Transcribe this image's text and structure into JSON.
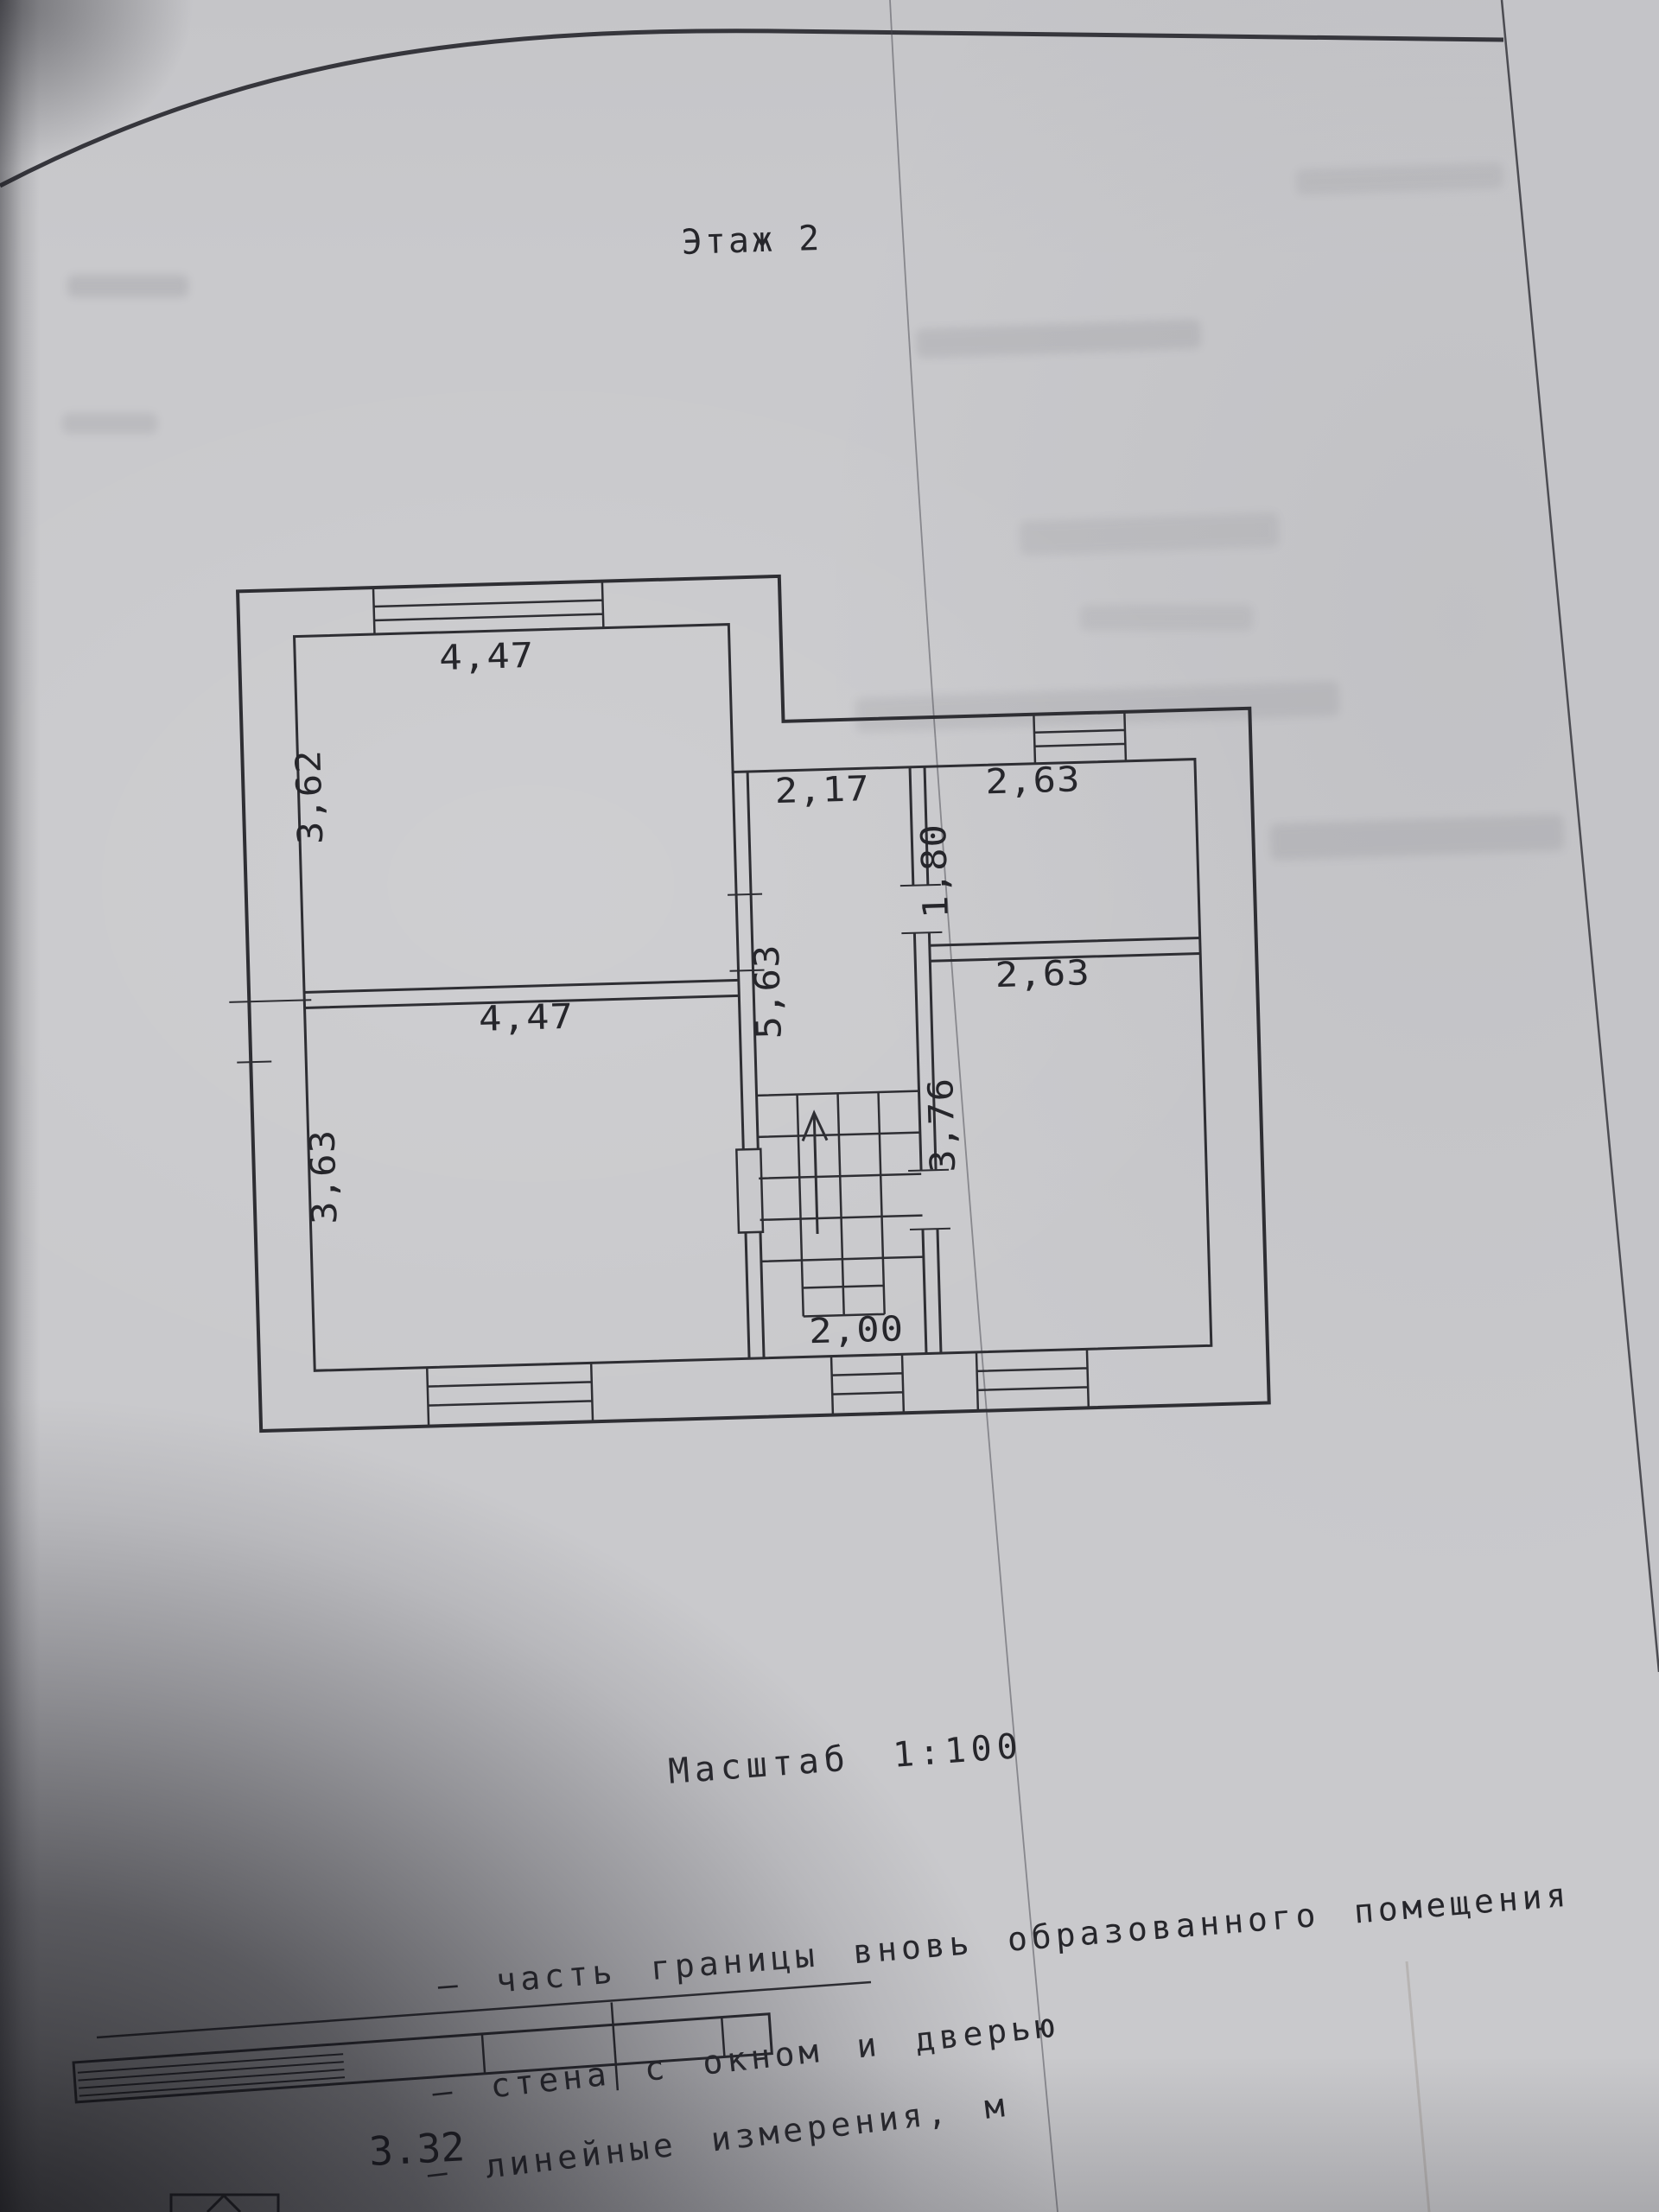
{
  "document": {
    "title": "Этаж 2",
    "scale": "Масштаб 1:100"
  },
  "floor_plan": {
    "rooms": [
      {
        "name": "room-top-left",
        "width": "4,47",
        "depth": "3,62"
      },
      {
        "name": "hall-with-stairs",
        "width": "2,17",
        "depth": "5,63"
      },
      {
        "name": "room-top-right",
        "width": "2,63",
        "depth": "1,80"
      },
      {
        "name": "room-bottom-left",
        "width": "4,47",
        "depth": "3,63"
      },
      {
        "name": "room-bottom-right",
        "width": "2,63",
        "depth": "3,76"
      }
    ],
    "stairs": {
      "width": "2,00"
    }
  },
  "legend": {
    "items": [
      {
        "symbol": "new-premises-boundary-line",
        "label": "– часть границы вновь образованного помещения"
      },
      {
        "symbol": "wall-with-window-and-door",
        "label": "– стена с окном и дверью"
      },
      {
        "symbol": "linear-measurement",
        "label": "– линейные измерения, м"
      }
    ]
  },
  "fragment": {
    "dimension": "3.32"
  }
}
